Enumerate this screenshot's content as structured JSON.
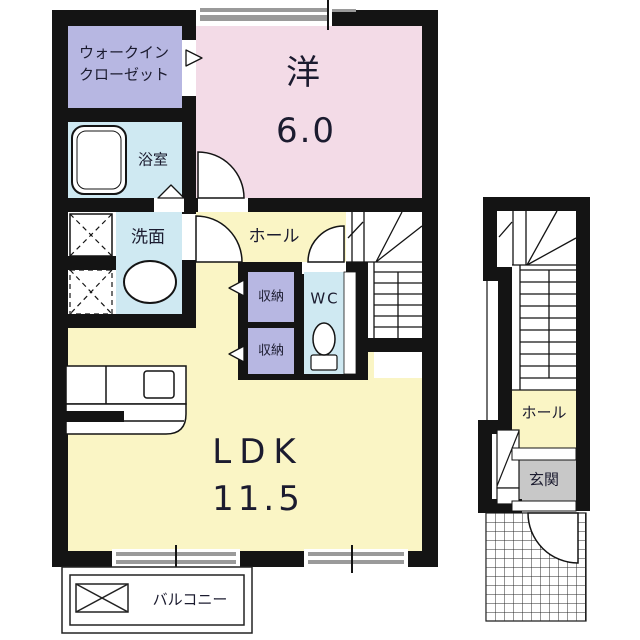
{
  "colors": {
    "wall": "#141414",
    "pink": "#f3dbe7",
    "lavender": "#b7b7e2",
    "yellow": "#faf5c5",
    "blue": "#cfe9f2",
    "gray": "#c8c8c8",
    "window_gray": "#9a9a9a",
    "white": "#ffffff"
  },
  "floor2": {
    "walk_in_closet_line1": "ウォークイン",
    "walk_in_closet_line2": "クローゼット",
    "western_room_label": "洋",
    "western_room_size": "6.0",
    "bathroom_label": "浴室",
    "washroom_label": "洗面",
    "hall_label": "ホール",
    "storage_top_label": "収納",
    "storage_bottom_label": "収納",
    "wc_label": "WC",
    "ldk_label": "LDK",
    "ldk_size": "11.5",
    "balcony_label": "バルコニー"
  },
  "floor1": {
    "hall_label": "ホール",
    "entrance_label": "玄関"
  }
}
